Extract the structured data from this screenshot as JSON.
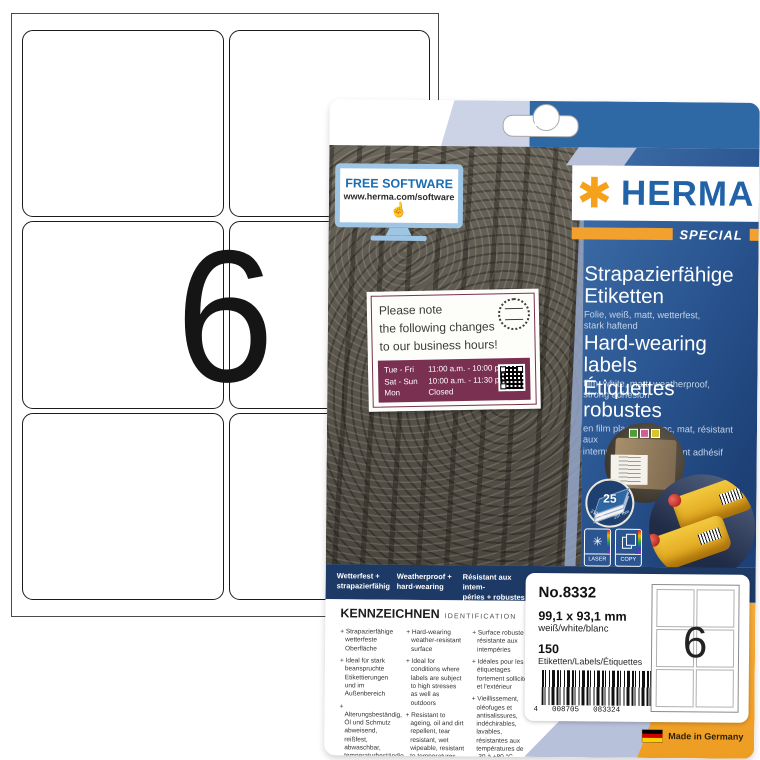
{
  "sheet": {
    "big_number": "6"
  },
  "package": {
    "free_software": {
      "title": "FREE SOFTWARE",
      "url": "www.herma.com/software"
    },
    "brand": {
      "name": "HERMA",
      "asterisk": "✱",
      "edition": "SPECIAL"
    },
    "products": [
      {
        "title": "Strapazierfähige\nEtiketten",
        "subtitle": "Folie, weiß, matt, wetterfest,\nstark haftend"
      },
      {
        "title": "Hard-wearing labels",
        "subtitle": "film, white, matt, weatherproof,\nstrong adhesion"
      },
      {
        "title": "Étiquettes robustes",
        "subtitle": "en film plastifié, blanc, mat, résistant aux\nintempéries, extrêmement adhésif"
      }
    ],
    "hours_label": {
      "title": "Please note\nthe following changes\nto our business hours!",
      "rows": [
        {
          "day": "Tue - Fri",
          "time": "11:00 a.m. - 10:00 p.m."
        },
        {
          "day": "Sat - Sun",
          "time": "10:00 a.m. - 11:30 p.m."
        },
        {
          "day": "Mon",
          "time": "Closed"
        }
      ]
    },
    "sheet_badge": {
      "count": "25",
      "width_mm": "210 mm",
      "height_mm": "297 mm"
    },
    "print_icons": [
      {
        "label": "LASER",
        "glyph": "✳"
      },
      {
        "label": "COPY"
      }
    ],
    "feature_bar": [
      {
        "text": "Wetterfest +\nstrapazierfähig"
      },
      {
        "text": "Weatherproof +\nhard-wearing"
      },
      {
        "text": "Résistant aux intem-\npéries + robustes"
      }
    ],
    "identification": {
      "heading": "KENNZEICHNEN",
      "subheading": "IDENTIFICATION",
      "columns": [
        {
          "items": [
            "Strapazierfähige wetterfeste Oberfläche",
            "Ideal für stark beanspruchte Etikettierungen und im Außenbereich",
            "Alterungsbeständig, Öl und Schmutz abweisend, reißfest, abwaschbar, temperaturbeständig von -30 bis +80 °C"
          ]
        },
        {
          "items": [
            "Hard-wearing weather-resistant surface",
            "Ideal for conditions where labels are subject to high stresses as well as outdoors",
            "Resistant to ageing, oil and dirt repellent, tear resistant, wet wipeable, resistant to temperatures between -30 and +80 °C"
          ]
        },
        {
          "items": [
            "Surface robuste et résistante aux intempéries",
            "Idéales pour les étiquetages fortement sollicités et l'extérieur",
            "Vieillissement, oléofuges et antisalissures, indéchirables, lavables, résistantes aux températures de -30 à +80 °C"
          ]
        }
      ]
    },
    "info_panel": {
      "number": "No.8332",
      "size": "99,1 x 93,1 mm",
      "color": "weiß/white/blanc",
      "count": "150",
      "count_label": "Etiketten/Labels/Étiquettes",
      "barcode": {
        "prefix": "4",
        "group1": "008705",
        "group2": "083324"
      },
      "mini_sheet_number": "6"
    },
    "made_in": "Made in Germany"
  },
  "colors": {
    "navy": "#1d3a66",
    "blue": "#2e68a5",
    "periwinkle": "#b8c1da",
    "orange": "#f2a12f",
    "herma_blue": "#2263a8",
    "herma_orange": "#f6a11c",
    "maroon": "#7a3050"
  }
}
